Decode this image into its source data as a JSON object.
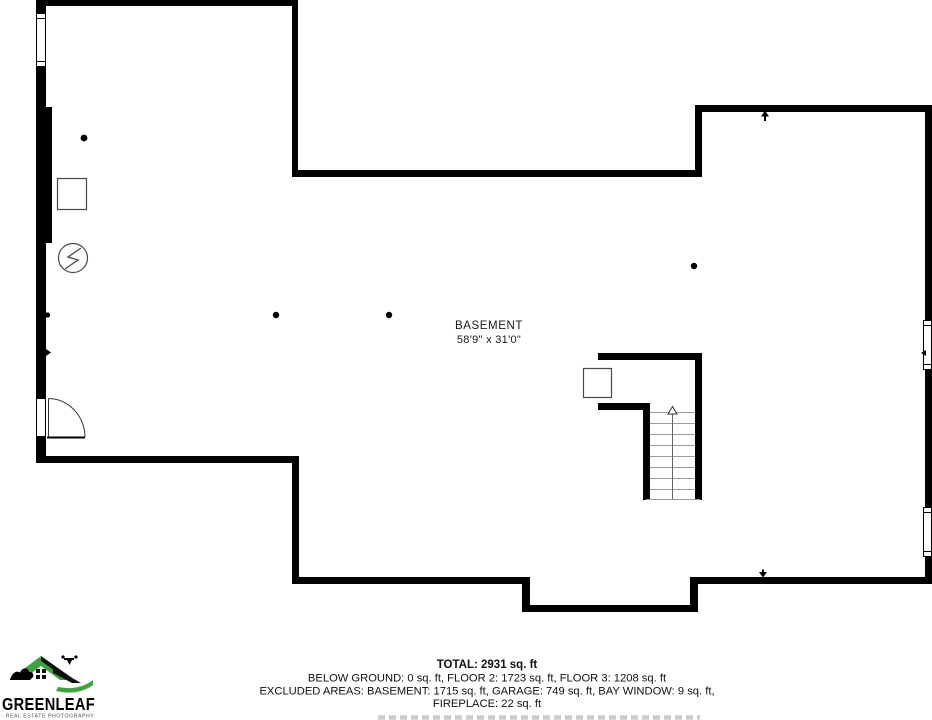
{
  "room": {
    "label": "BASEMENT",
    "dimensions": "58'9\" x 31'0\""
  },
  "summary": {
    "total": "TOTAL: 2931 sq. ft",
    "floors": "BELOW GROUND: 0 sq. ft, FLOOR 2: 1723 sq. ft, FLOOR 3: 1208 sq. ft",
    "excluded": "EXCLUDED AREAS: BASEMENT: 1715 sq. ft, GARAGE: 749 sq. ft, BAY WINDOW: 9 sq. ft,",
    "excluded2": "FIREPLACE: 22 sq. ft"
  },
  "logo": {
    "name": "GREENLEAF",
    "tagline": "REAL ESTATE PHOTOGRAPHY",
    "green": "#3EA33E",
    "black": "#000000"
  },
  "colors": {
    "wall": "#000000",
    "fixture_outline": "#4a4a4a",
    "stair_tread": "#9a9a9a",
    "clipped_text": "#cccccc"
  },
  "icons": {
    "electrical": "circle-lightning-icon",
    "left_fixture": "square-fixture-icon",
    "stair_fixture": "square-fixture-icon",
    "stair_direction": "up-arrow-icon",
    "door": "door-swing-arc",
    "window": "window-symbol"
  }
}
